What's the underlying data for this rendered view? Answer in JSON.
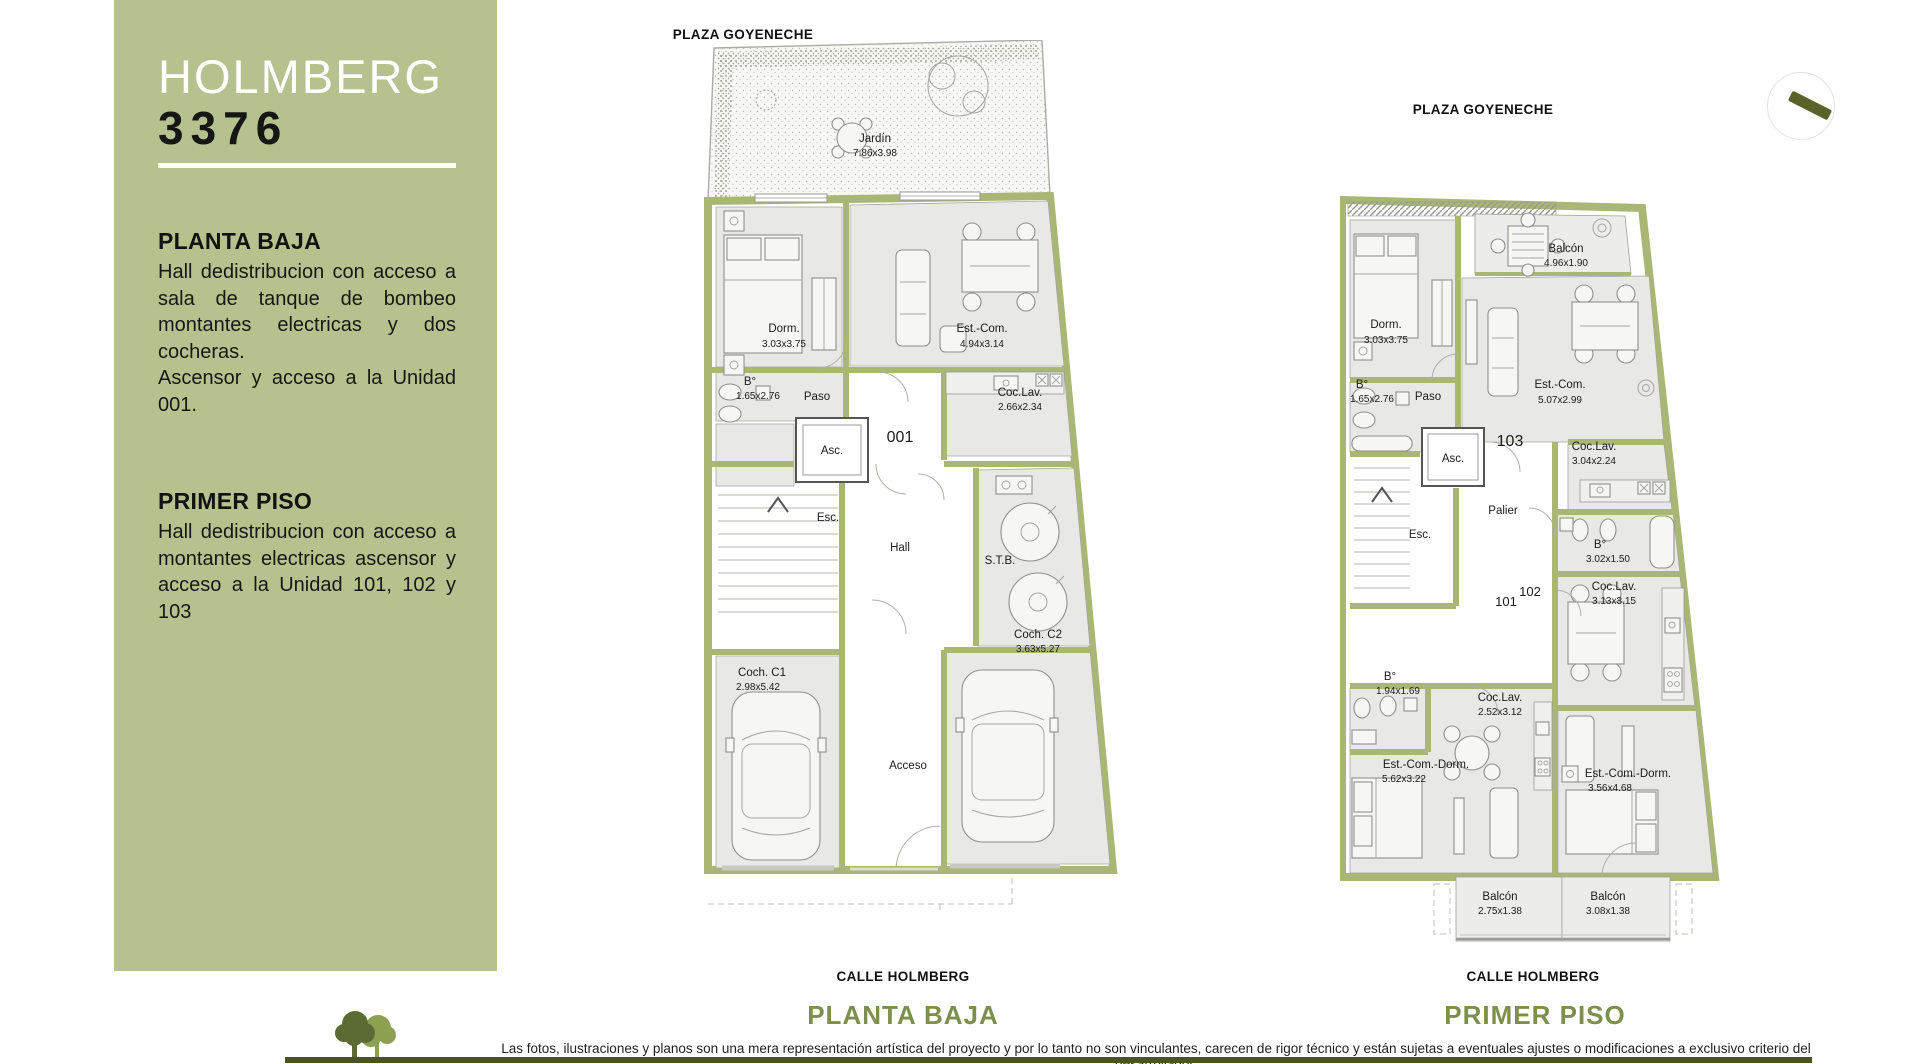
{
  "sidebar": {
    "title": "HOLMBERG",
    "number": "3376",
    "sections": [
      {
        "heading": "PLANTA BAJA",
        "paragraphs": [
          "Hall dedistribucion con acceso a sala de tanque de bombeo montantes electricas y dos cocheras.",
          "Ascensor y acceso a la Unidad 001."
        ]
      },
      {
        "heading": "PRIMER PISO",
        "paragraphs": [
          "Hall dedistribucion con acceso a montantes electricas ascensor y acceso a la Unidad 101, 102 y 103"
        ]
      }
    ]
  },
  "planta_baja": {
    "street_top": "PLAZA GOYENECHE",
    "street_bottom": "CALLE HOLMBERG",
    "caption": "PLANTA BAJA",
    "unit": "001",
    "rooms": {
      "jardin": {
        "name": "Jardín",
        "dims": "7.86x3.98"
      },
      "dorm": {
        "name": "Dorm.",
        "dims": "3.03x3.75"
      },
      "est_com": {
        "name": "Est.-Com.",
        "dims": "4.94x3.14"
      },
      "coc_lav": {
        "name": "Coc.Lav.",
        "dims": "2.66x2.34"
      },
      "bano": {
        "name": "B°",
        "dims": "1.65x2.76"
      },
      "paso": {
        "name": "Paso"
      },
      "asc": {
        "name": "Asc."
      },
      "esc": {
        "name": "Esc."
      },
      "hall": {
        "name": "Hall"
      },
      "stb": {
        "name": "S.T.B."
      },
      "coch_c1": {
        "name": "Coch. C1",
        "dims": "2.98x5.42"
      },
      "coch_c2": {
        "name": "Coch. C2",
        "dims": "3.63x5.27"
      },
      "acceso": {
        "name": "Acceso"
      }
    }
  },
  "primer_piso": {
    "street_top": "PLAZA GOYENECHE",
    "street_bottom": "CALLE HOLMBERG",
    "caption": "PRIMER PISO",
    "units": {
      "u101": "101",
      "u102": "102",
      "u103": "103"
    },
    "rooms": {
      "balcon_norte": {
        "name": "Balcón",
        "dims": "4.96x1.90"
      },
      "dorm": {
        "name": "Dorm.",
        "dims": "3.03x3.75"
      },
      "est_com": {
        "name": "Est.-Com.",
        "dims": "5.07x2.99"
      },
      "bano_1": {
        "name": "B°",
        "dims": "1.65x2.76"
      },
      "paso": {
        "name": "Paso"
      },
      "asc": {
        "name": "Asc."
      },
      "coc_lav_103": {
        "name": "Coc.Lav.",
        "dims": "3.04x2.24"
      },
      "palier": {
        "name": "Palier"
      },
      "esc": {
        "name": "Esc."
      },
      "bano_102": {
        "name": "B°",
        "dims": "3.02x1.50"
      },
      "coc_lav_102": {
        "name": "Coc.Lav.",
        "dims": "3.13x3.15"
      },
      "bano_101": {
        "name": "B°",
        "dims": "1.94x1.69"
      },
      "coc_lav_101": {
        "name": "Coc.Lav.",
        "dims": "2.52x3.12"
      },
      "est_com_dorm_101": {
        "name": "Est.-Com.-Dorm.",
        "dims": "5.62x3.22"
      },
      "est_com_dorm_102": {
        "name": "Est.-Com.-Dorm.",
        "dims": "3.56x4.68"
      },
      "balcon_101": {
        "name": "Balcón",
        "dims": "2.75x1.38"
      },
      "balcon_102": {
        "name": "Balcón",
        "dims": "3.08x1.38"
      }
    }
  },
  "footer": {
    "disclaimer": "Las fotos, ilustraciones y planos son una mera representación artística del proyecto y por lo tanto no son vinculantes, carecen de rigor técnico y están sujetas a eventuales ajustes o modificaciones a exclusivo criterio del desarrollador."
  },
  "colors": {
    "sidebar_green": "#b5c28e",
    "wall_green": "#a9b674",
    "caption_green": "#7d8f4c",
    "footer_bar_green": "#4a5322",
    "room_fill": "#e8e8e5"
  }
}
